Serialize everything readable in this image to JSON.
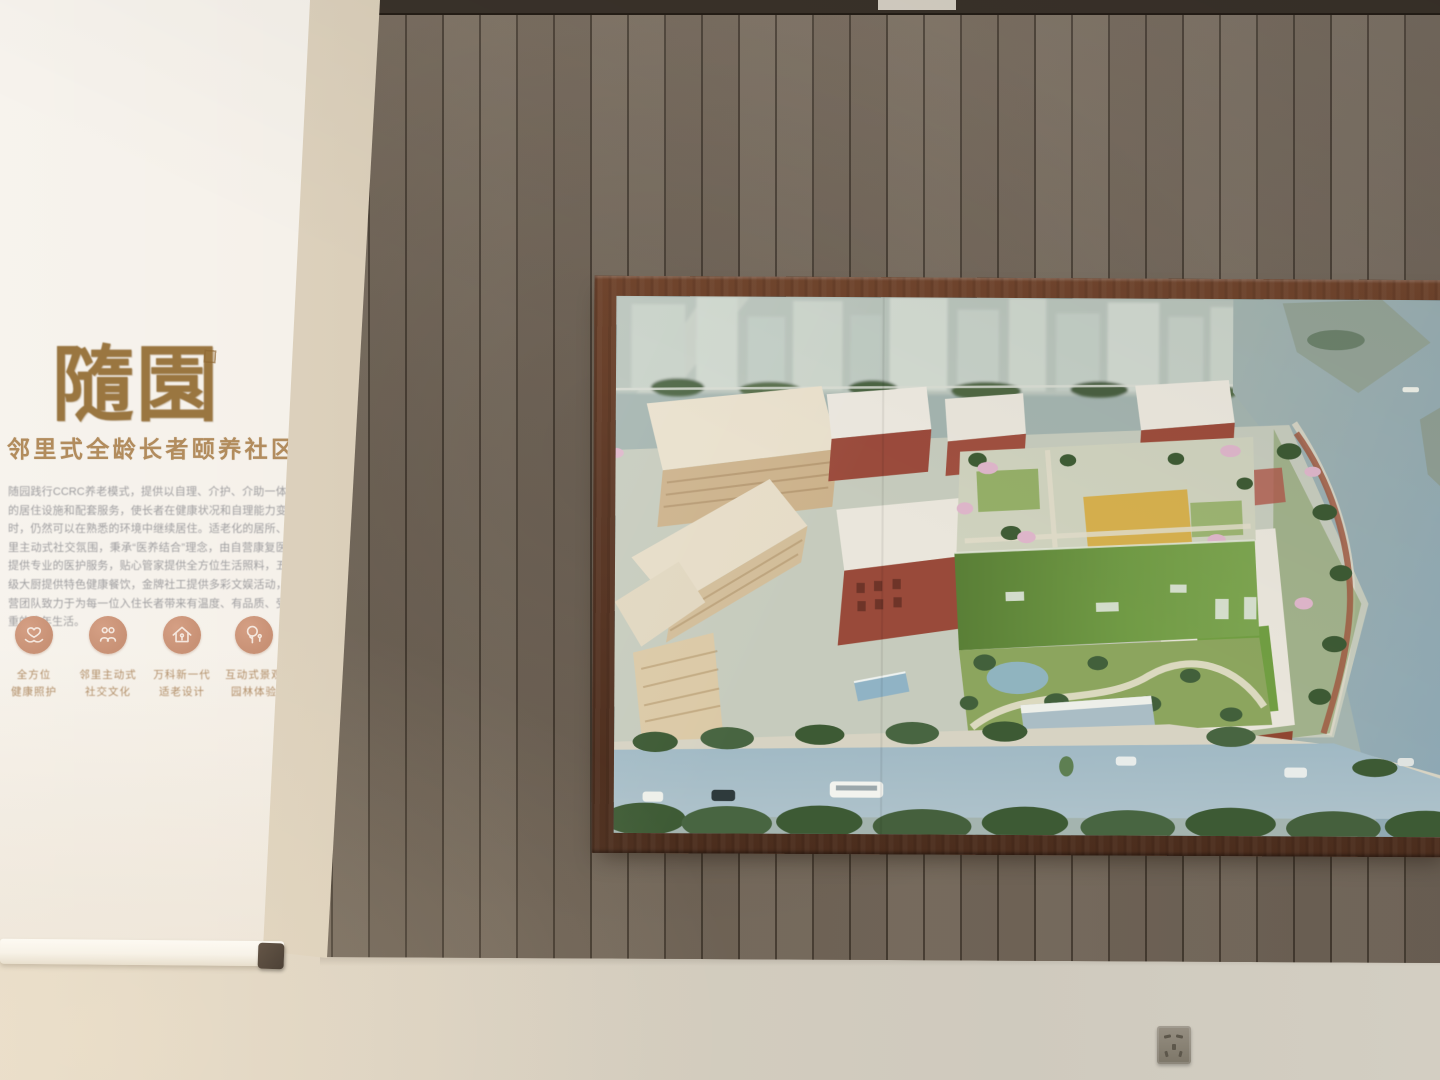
{
  "banner": {
    "title": "隨園",
    "subtitle": "邻里式全龄长者颐养社区",
    "body": "随园践行CCRC养老模式，提供以自理、介护、介助一体化的居住设施和配套服务，使长者在健康状况和自理能力变化时，仍然可以在熟悉的环境中继续居住。适老化的居所、邻里主动式社交氛围，秉承“医养结合”理念，由自营康复医院提供专业的医护服务，贴心管家提供全方位生活照料，五星级大厨提供特色健康餐饮，金牌社工提供多彩文娱活动，运营团队致力于为每一位入住长者带来有温度、有品质、受尊重的晚年生活。",
    "features": [
      {
        "icon": "heart-hands-icon",
        "line1": "全方位",
        "line2": "健康照护"
      },
      {
        "icon": "people-icon",
        "line1": "邻里主动式",
        "line2": "社交文化"
      },
      {
        "icon": "house-icon",
        "line1": "万科新一代",
        "line2": "适老设计"
      },
      {
        "icon": "tree-icon",
        "line1": "互动式景观",
        "line2": "园林体验"
      }
    ]
  },
  "colors": {
    "wood_wall": "#76695b",
    "wood_groove": "#3f372e",
    "wall_top_band": "#3a322a",
    "lower_wall": "#d5cec1",
    "banner_bg": "#f4efe7",
    "title_brown": "#9a7640",
    "subtitle_brown": "#b28c5d",
    "body_gray": "#9f9ea0",
    "icon_terracotta": "#c78f73",
    "caption_brown": "#ae8a63",
    "frame_wood": "#5d3a28",
    "water": "#a3b4af",
    "river": "#8ea9b6",
    "road": "#a7bfca",
    "green_roof": "#6a9540",
    "red_brick": "#9e4a3a",
    "cream_building": "#e7ddc5",
    "blossom_pink": "#ddb3c8"
  }
}
